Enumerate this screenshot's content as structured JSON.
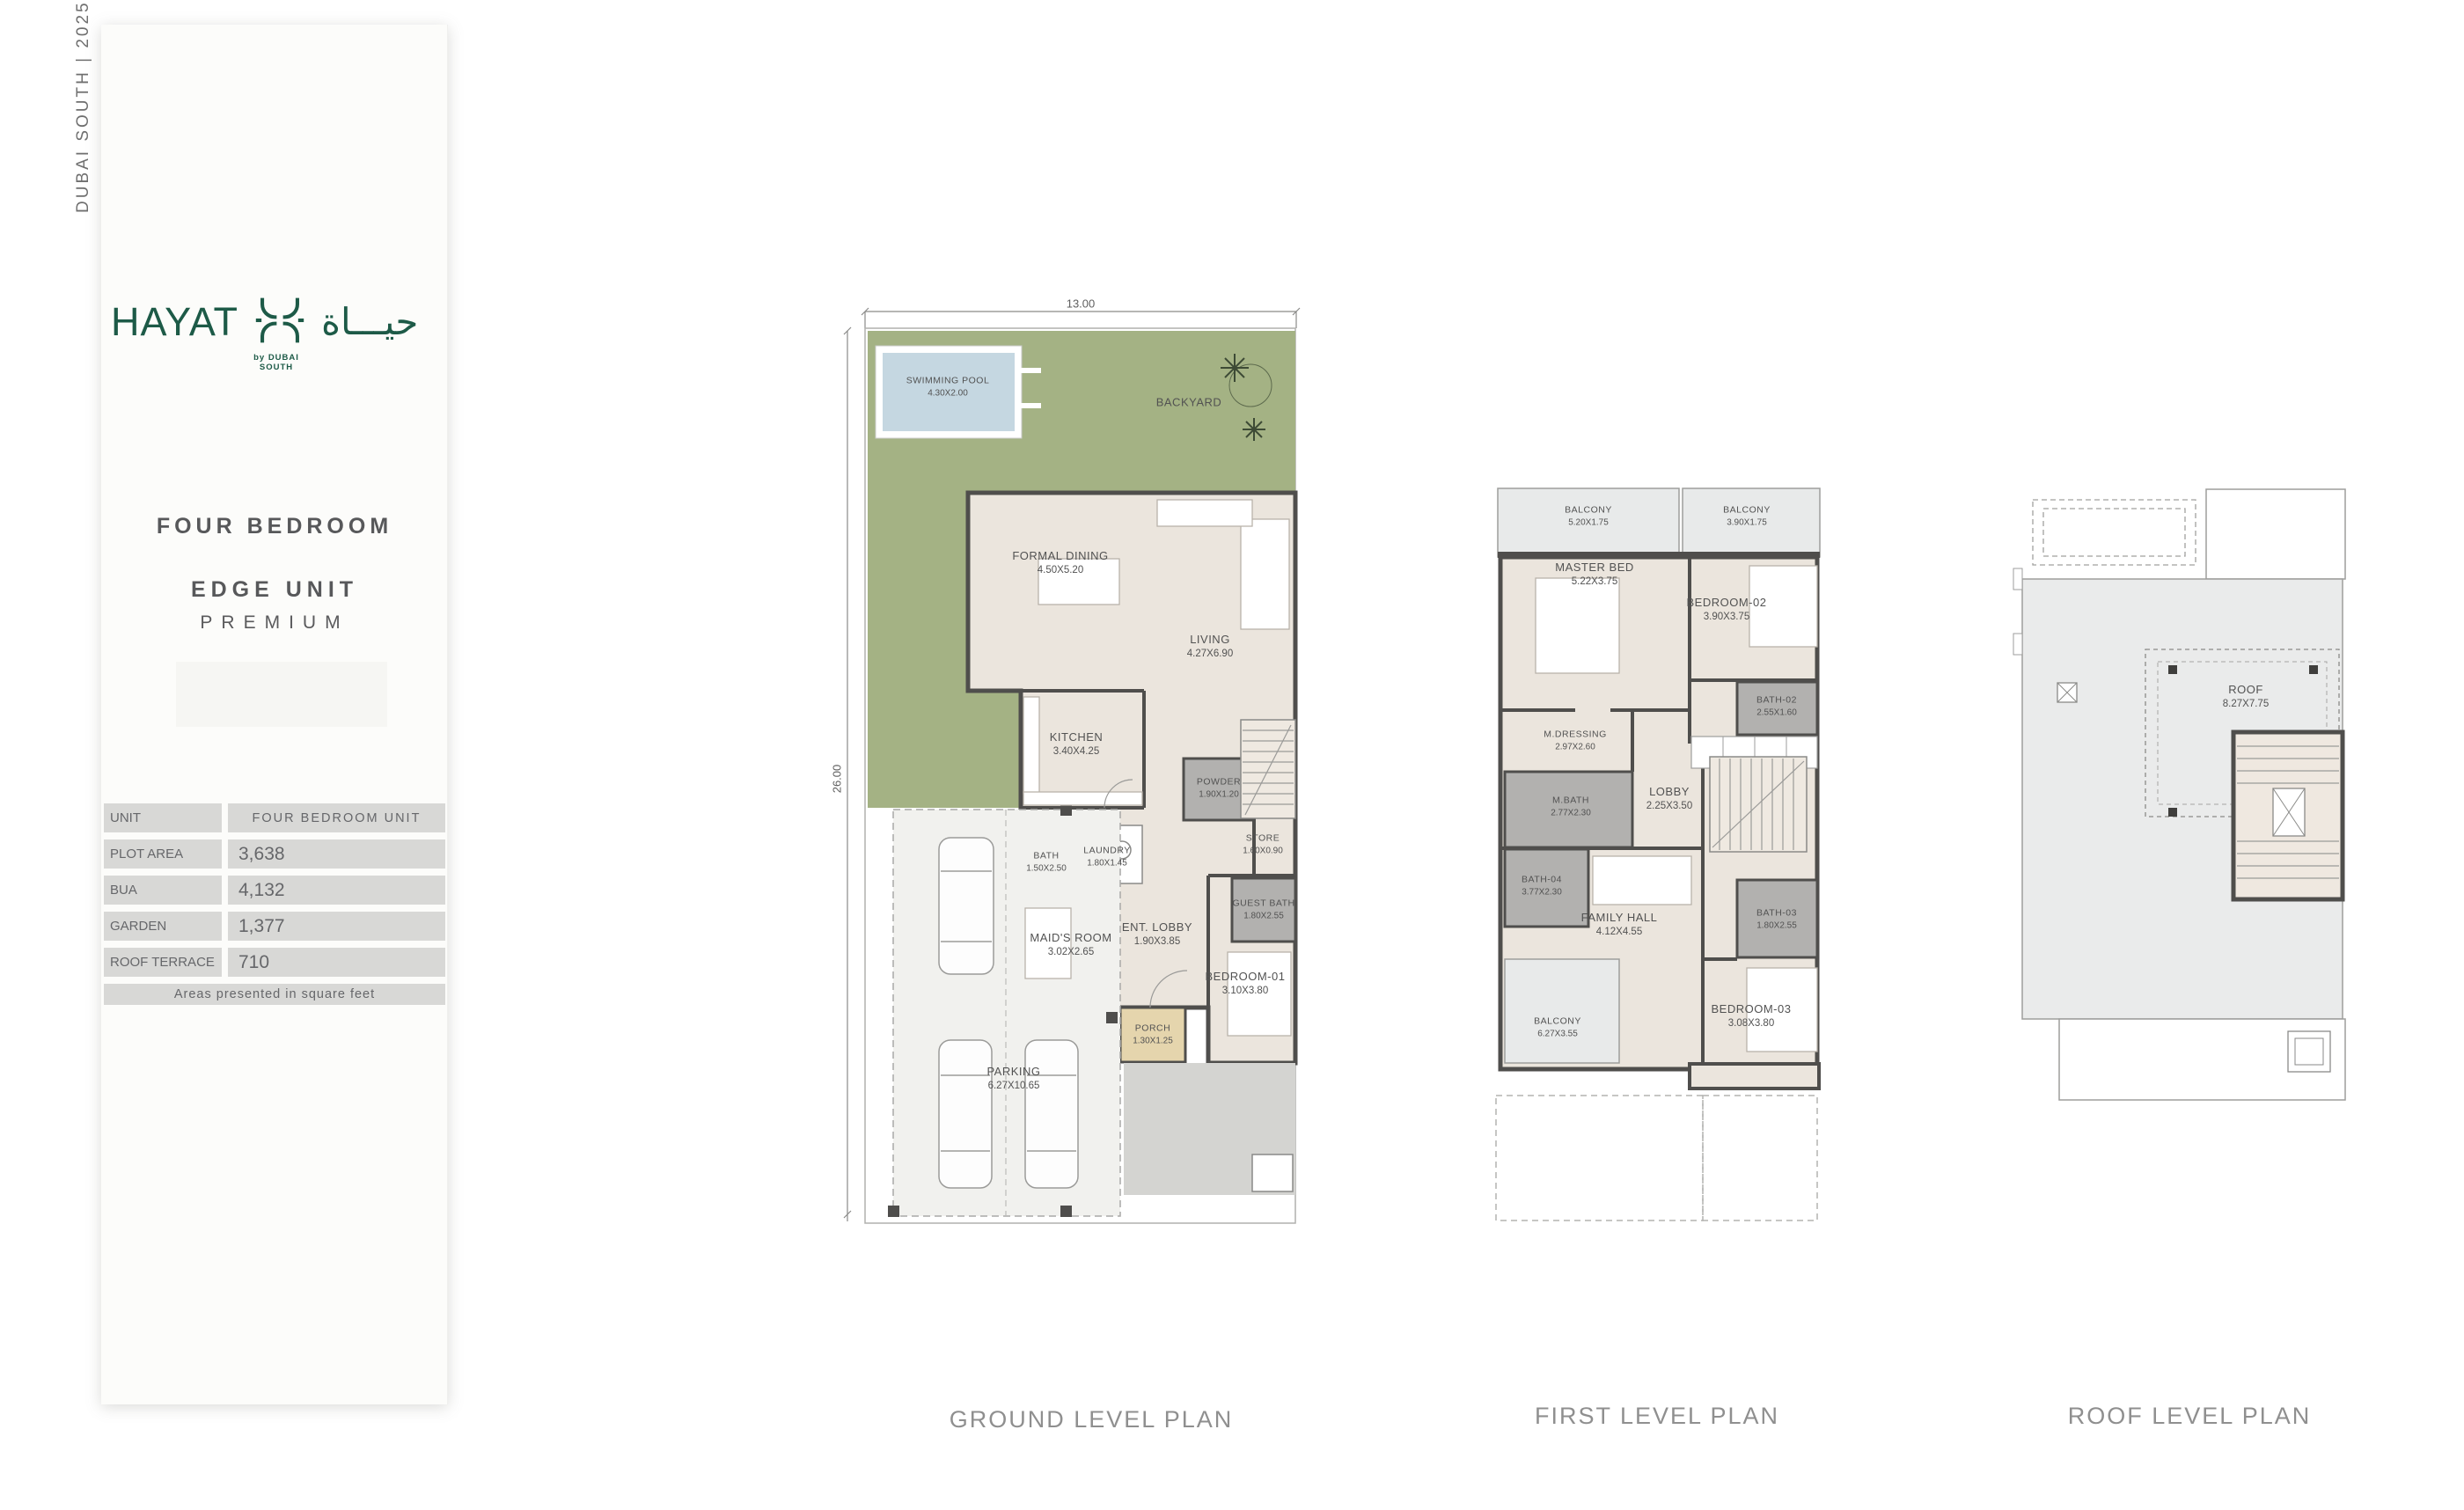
{
  "edition": "DUBAI SOUTH  |  2025",
  "brand": {
    "name": "HAYAT",
    "arabic": "حيـــاة",
    "byline": "by DUBAI SOUTH"
  },
  "unit": {
    "line1": "FOUR BEDROOM",
    "line2": "EDGE UNIT",
    "line3": "PREMIUM"
  },
  "spec_table": {
    "rows": [
      {
        "label": "UNIT",
        "value": "FOUR BEDROOM UNIT"
      },
      {
        "label": "PLOT AREA",
        "value": "3,638"
      },
      {
        "label": "BUA",
        "value": "4,132"
      },
      {
        "label": "GARDEN",
        "value": "1,377"
      },
      {
        "label": "ROOF TERRACE",
        "value": "710"
      }
    ],
    "footnote": "Areas presented in square feet"
  },
  "plans": {
    "ground": {
      "title": "GROUND LEVEL PLAN",
      "dim_top": "13.00",
      "dim_left": "26.00",
      "rooms": [
        {
          "name": "SWIMMING POOL",
          "dims": "4.30X2.00"
        },
        {
          "name": "BACKYARD"
        },
        {
          "name": "FORMAL DINING",
          "dims": "4.50X5.20"
        },
        {
          "name": "LIVING",
          "dims": "4.27X6.90"
        },
        {
          "name": "KITCHEN",
          "dims": "3.40X4.25"
        },
        {
          "name": "POWDER",
          "dims": "1.90X1.20"
        },
        {
          "name": "STORE",
          "dims": "1.60X0.90"
        },
        {
          "name": "LAUNDRY",
          "dims": "1.80X1.45"
        },
        {
          "name": "BATH",
          "dims": "1.50X2.50"
        },
        {
          "name": "MAID'S ROOM",
          "dims": "3.02X2.65"
        },
        {
          "name": "ENT. LOBBY",
          "dims": "1.90X3.85"
        },
        {
          "name": "GUEST BATH",
          "dims": "1.80X2.55"
        },
        {
          "name": "BEDROOM-01",
          "dims": "3.10X3.80"
        },
        {
          "name": "PORCH",
          "dims": "1.30X1.25"
        },
        {
          "name": "PARKING",
          "dims": "6.27X10.65"
        }
      ]
    },
    "first": {
      "title": "FIRST LEVEL PLAN",
      "rooms": [
        {
          "name": "BALCONY",
          "dims": "5.20X1.75"
        },
        {
          "name": "BALCONY",
          "dims": "3.90X1.75"
        },
        {
          "name": "MASTER BED",
          "dims": "5.22X3.75"
        },
        {
          "name": "BEDROOM-02",
          "dims": "3.90X3.75"
        },
        {
          "name": "BATH-02",
          "dims": "2.55X1.60"
        },
        {
          "name": "M.DRESSING",
          "dims": "2.97X2.60"
        },
        {
          "name": "M.BATH",
          "dims": "2.77X2.30"
        },
        {
          "name": "LOBBY",
          "dims": "2.25X3.50"
        },
        {
          "name": "BATH-04",
          "dims": "3.77X2.30"
        },
        {
          "name": "FAMILY HALL",
          "dims": "4.12X4.55"
        },
        {
          "name": "BATH-03",
          "dims": "1.80X2.55"
        },
        {
          "name": "BEDROOM-03",
          "dims": "3.08X3.80"
        },
        {
          "name": "BALCONY",
          "dims": "6.27X3.55"
        }
      ]
    },
    "roof": {
      "title": "ROOF LEVEL PLAN",
      "rooms": [
        {
          "name": "ROOF",
          "dims": "8.27X7.75"
        }
      ]
    }
  },
  "colors": {
    "brand_green": "#1d5a47",
    "garden": "#a4b284",
    "pool": "#c5d7e1",
    "wall": "#4f4e4c",
    "floor": "#ebe5dd",
    "bath_fill": "#b2b1af",
    "balcony": "#e8eaea",
    "porch": "#e5d5ad",
    "patio": "#d4d4d1",
    "table_cell": "#d8d8d6"
  }
}
